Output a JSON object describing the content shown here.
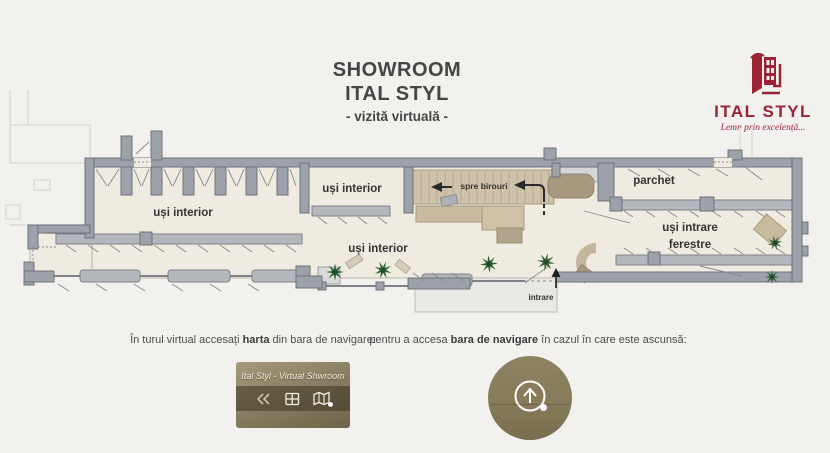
{
  "header": {
    "title_line1": "SHOWROOM",
    "title_line2": "ITAL STYL",
    "subtitle": "- vizită virtuală -"
  },
  "logo": {
    "brand": "ITAL STYL",
    "tagline": "Lemn prin excelență...",
    "brand_color": "#9b2334"
  },
  "floorplan": {
    "labels": {
      "left_zone": "uși interior",
      "mid_top_zone": "uși interior",
      "mid_bottom_zone": "uși interior",
      "stairs": "spre birouri",
      "right_top_zone": "parchet",
      "right_zone_line1": "uși intrare",
      "right_zone_line2": "ferestre",
      "entrance": "intrare"
    },
    "colors": {
      "wall": "#9da1a9",
      "floor": "#f0ebe0",
      "stairs": "#cec2ab",
      "display_rack": "#b4b7bb",
      "plant": "#2f5d33",
      "brand_accent": "#9b2334"
    }
  },
  "instructions": {
    "left_pre": "În turul virtual accesați ",
    "left_bold": "harta",
    "left_post": " din bara de navigare:",
    "right_pre": "pentru a accesa ",
    "right_bold": "bara de navigare",
    "right_post": " în cazul în care este ascunsă:"
  },
  "navbar_image": {
    "title": "Ital Styl - Virtual Shwroom",
    "icons": [
      "rewind-icon",
      "grid-icon",
      "map-icon"
    ]
  },
  "hotspot_image": {
    "icon": "up-arrow-icon"
  }
}
